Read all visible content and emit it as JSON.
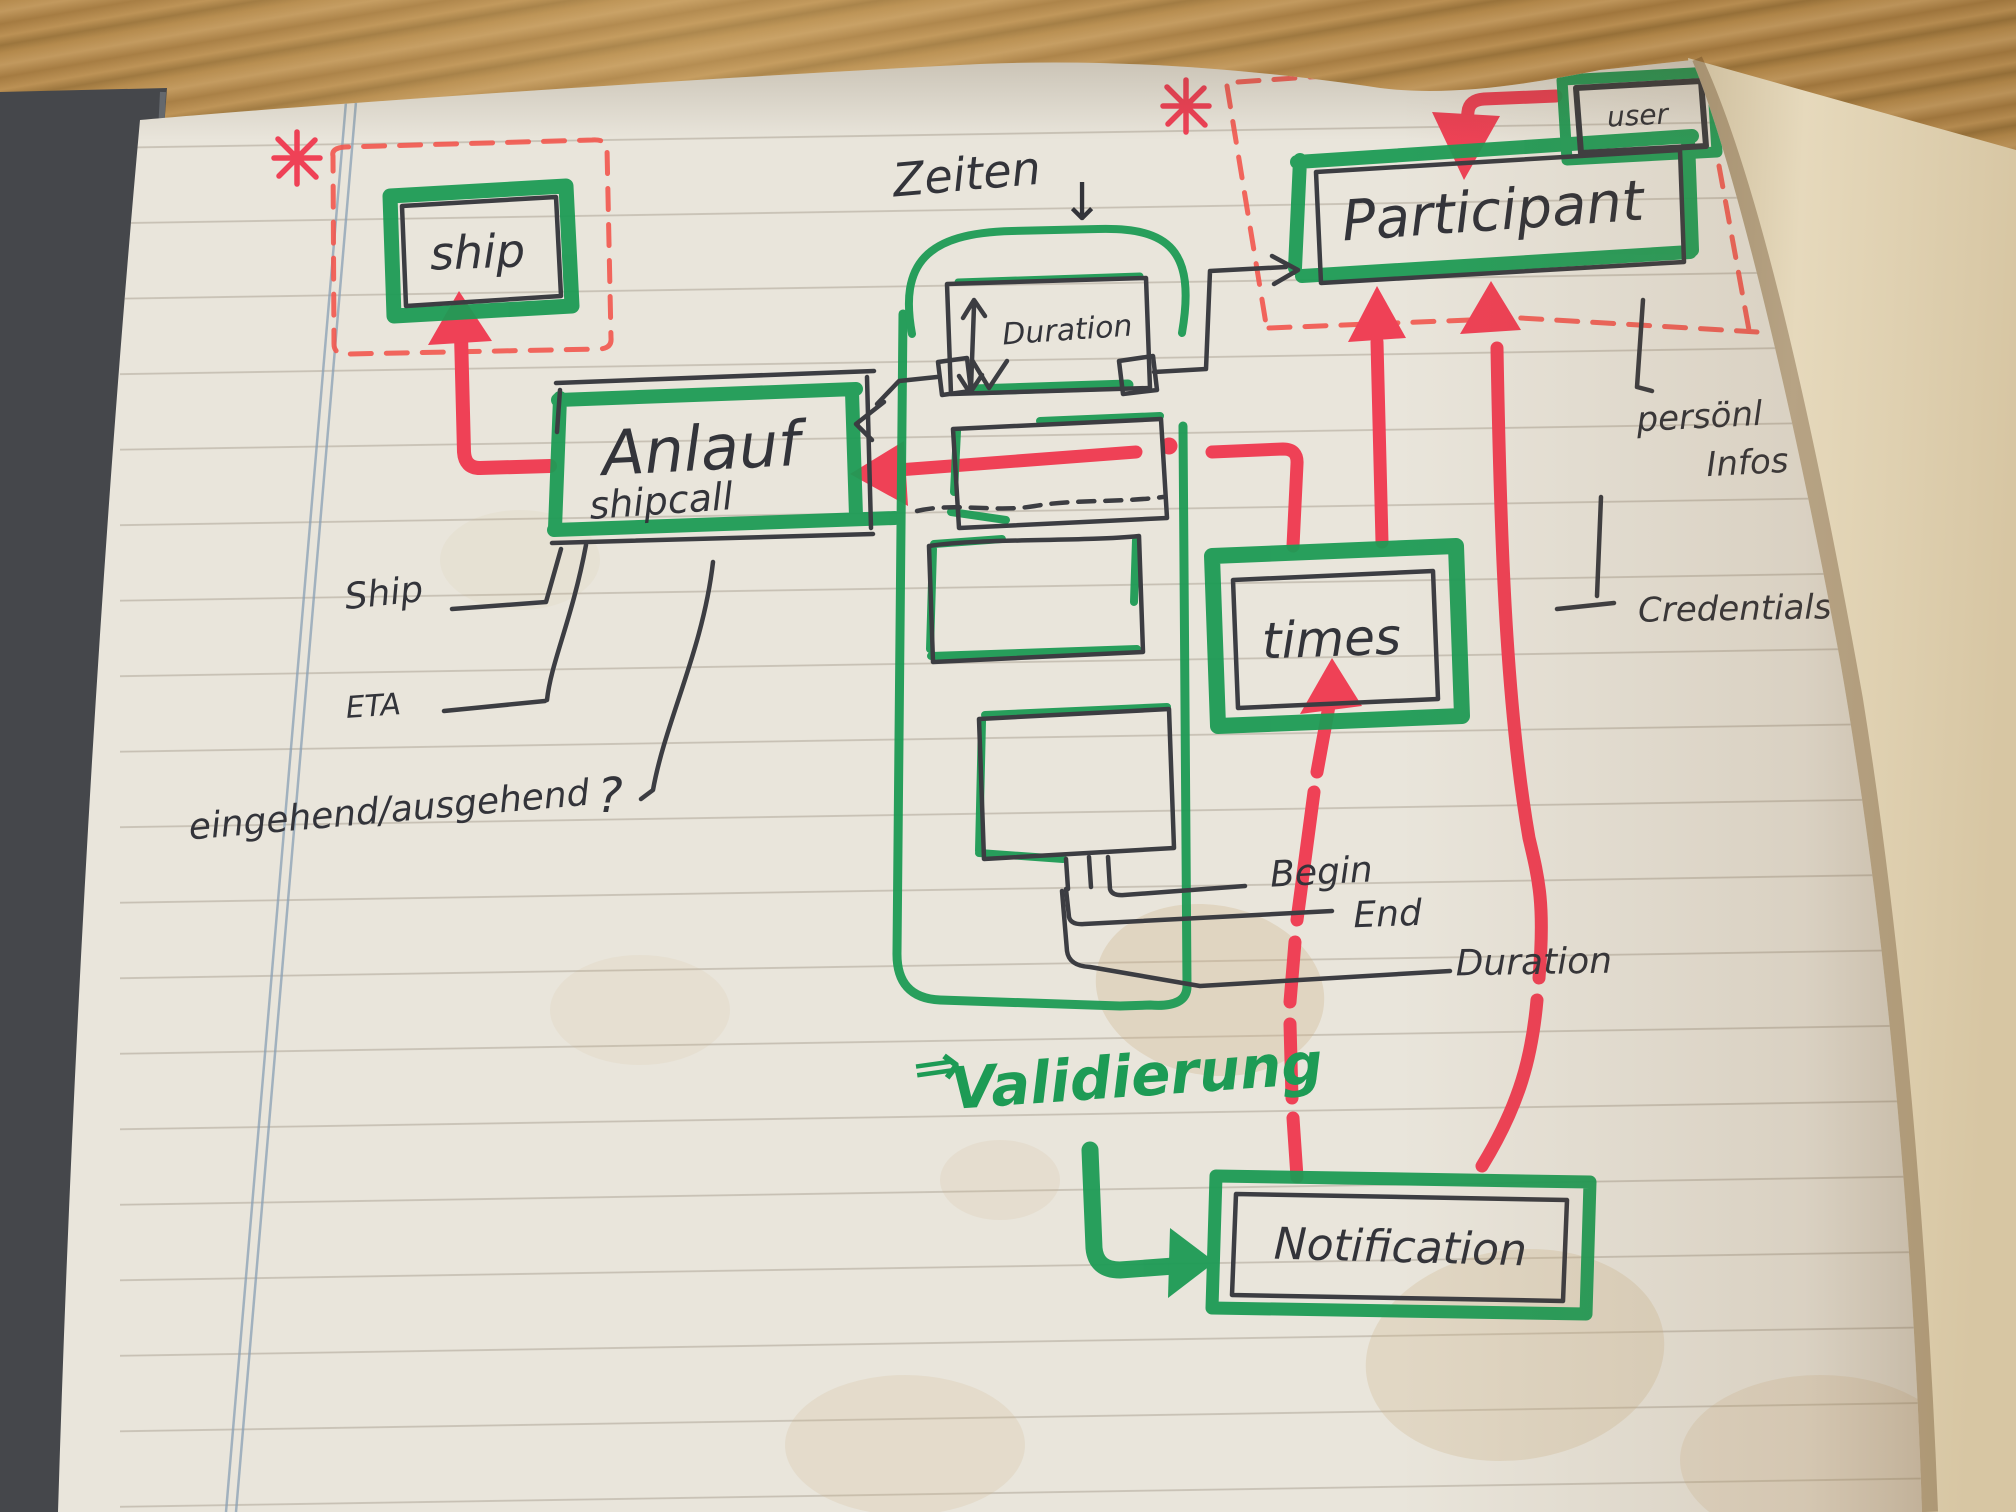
{
  "colors": {
    "marker_green": "#1d9b55",
    "marker_red": "#ef4156",
    "dashed_red": "#f2564e",
    "pen": "#3c3d42",
    "page": "#e9e5db",
    "wood": "#a87c40",
    "cover": "#45474b",
    "margin_line": "#8aa0b5"
  },
  "icons": {
    "asterisk": "*",
    "down_arrow": "↓",
    "double_arrow": "⇒"
  },
  "entities": {
    "ship": {
      "label": "ship"
    },
    "anlauf": {
      "label": "Anlauf",
      "sublabel": "shipcall"
    },
    "duration": {
      "label": "Duration"
    },
    "participant": {
      "label": "Participant"
    },
    "user": {
      "label": "user"
    },
    "times": {
      "label": "times"
    },
    "notification": {
      "label": "Notification"
    }
  },
  "attributes": {
    "ship_ref": "Ship",
    "eta": "ETA",
    "in_out": "eingehend/ausgehend",
    "question_mark": "?",
    "begin": "Begin",
    "end": "End",
    "duration": "Duration",
    "personal_info_line1": "persönl",
    "personal_info_line2": "Infos",
    "credentials": "Credentials"
  },
  "notes": {
    "zeiten": "Zeiten",
    "validation": "Validierung"
  }
}
